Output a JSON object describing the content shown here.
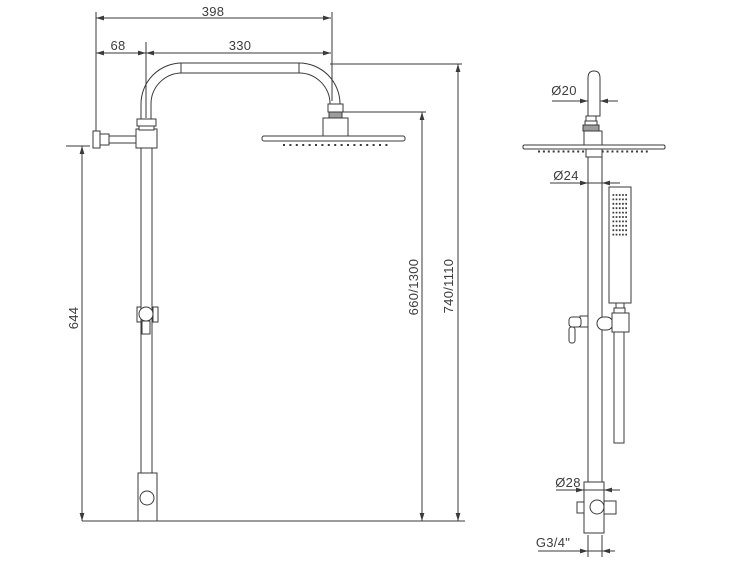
{
  "colors": {
    "line": "#3a3a3a",
    "text": "#3d3d3d",
    "shading": "#9c9c9c",
    "background": "#ffffff"
  },
  "front_view": {
    "dim_total_width": "398",
    "dim_wall_offset": "68",
    "dim_arm_length": "330",
    "dim_column_height": "644",
    "dim_head_height": "660/1300",
    "dim_overall_height": "740/1110"
  },
  "side_view": {
    "dim_arm_diameter": "Ø20",
    "dim_pipe_diameter": "Ø24",
    "dim_body_diameter": "Ø28",
    "dim_thread": "G3/4\""
  }
}
